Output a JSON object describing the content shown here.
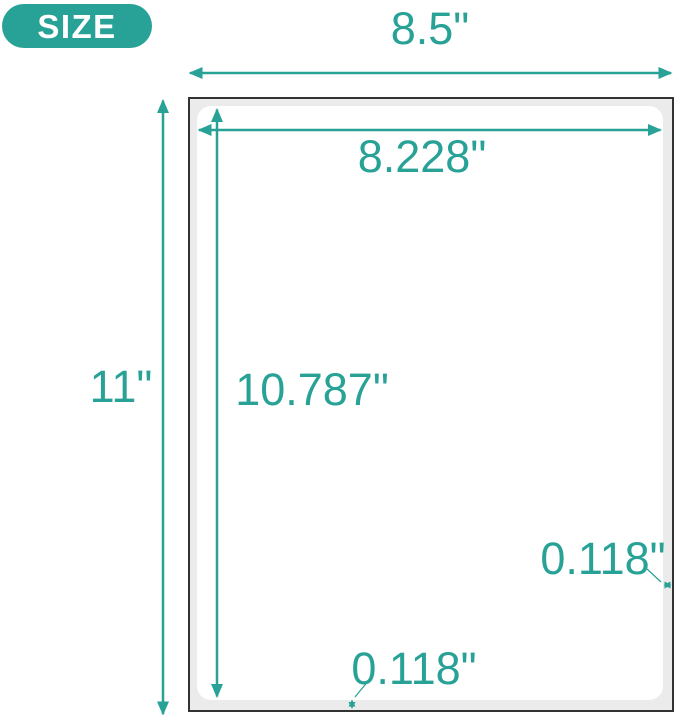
{
  "badge": {
    "label": "SIZE"
  },
  "sheet": {
    "width_label": "8.5\"",
    "height_label": "11\"",
    "inner_width_label": "8.228\"",
    "inner_height_label": "10.787\"",
    "right_margin_label": "0.118\"",
    "bottom_margin_label": "0.118\""
  },
  "colors": {
    "accent_teal": "#28a296",
    "sheet_border": "#333333",
    "sheet_margin_gray": "#ebebeb",
    "label_area_white": "#ffffff",
    "badge_text": "#ffffff"
  }
}
